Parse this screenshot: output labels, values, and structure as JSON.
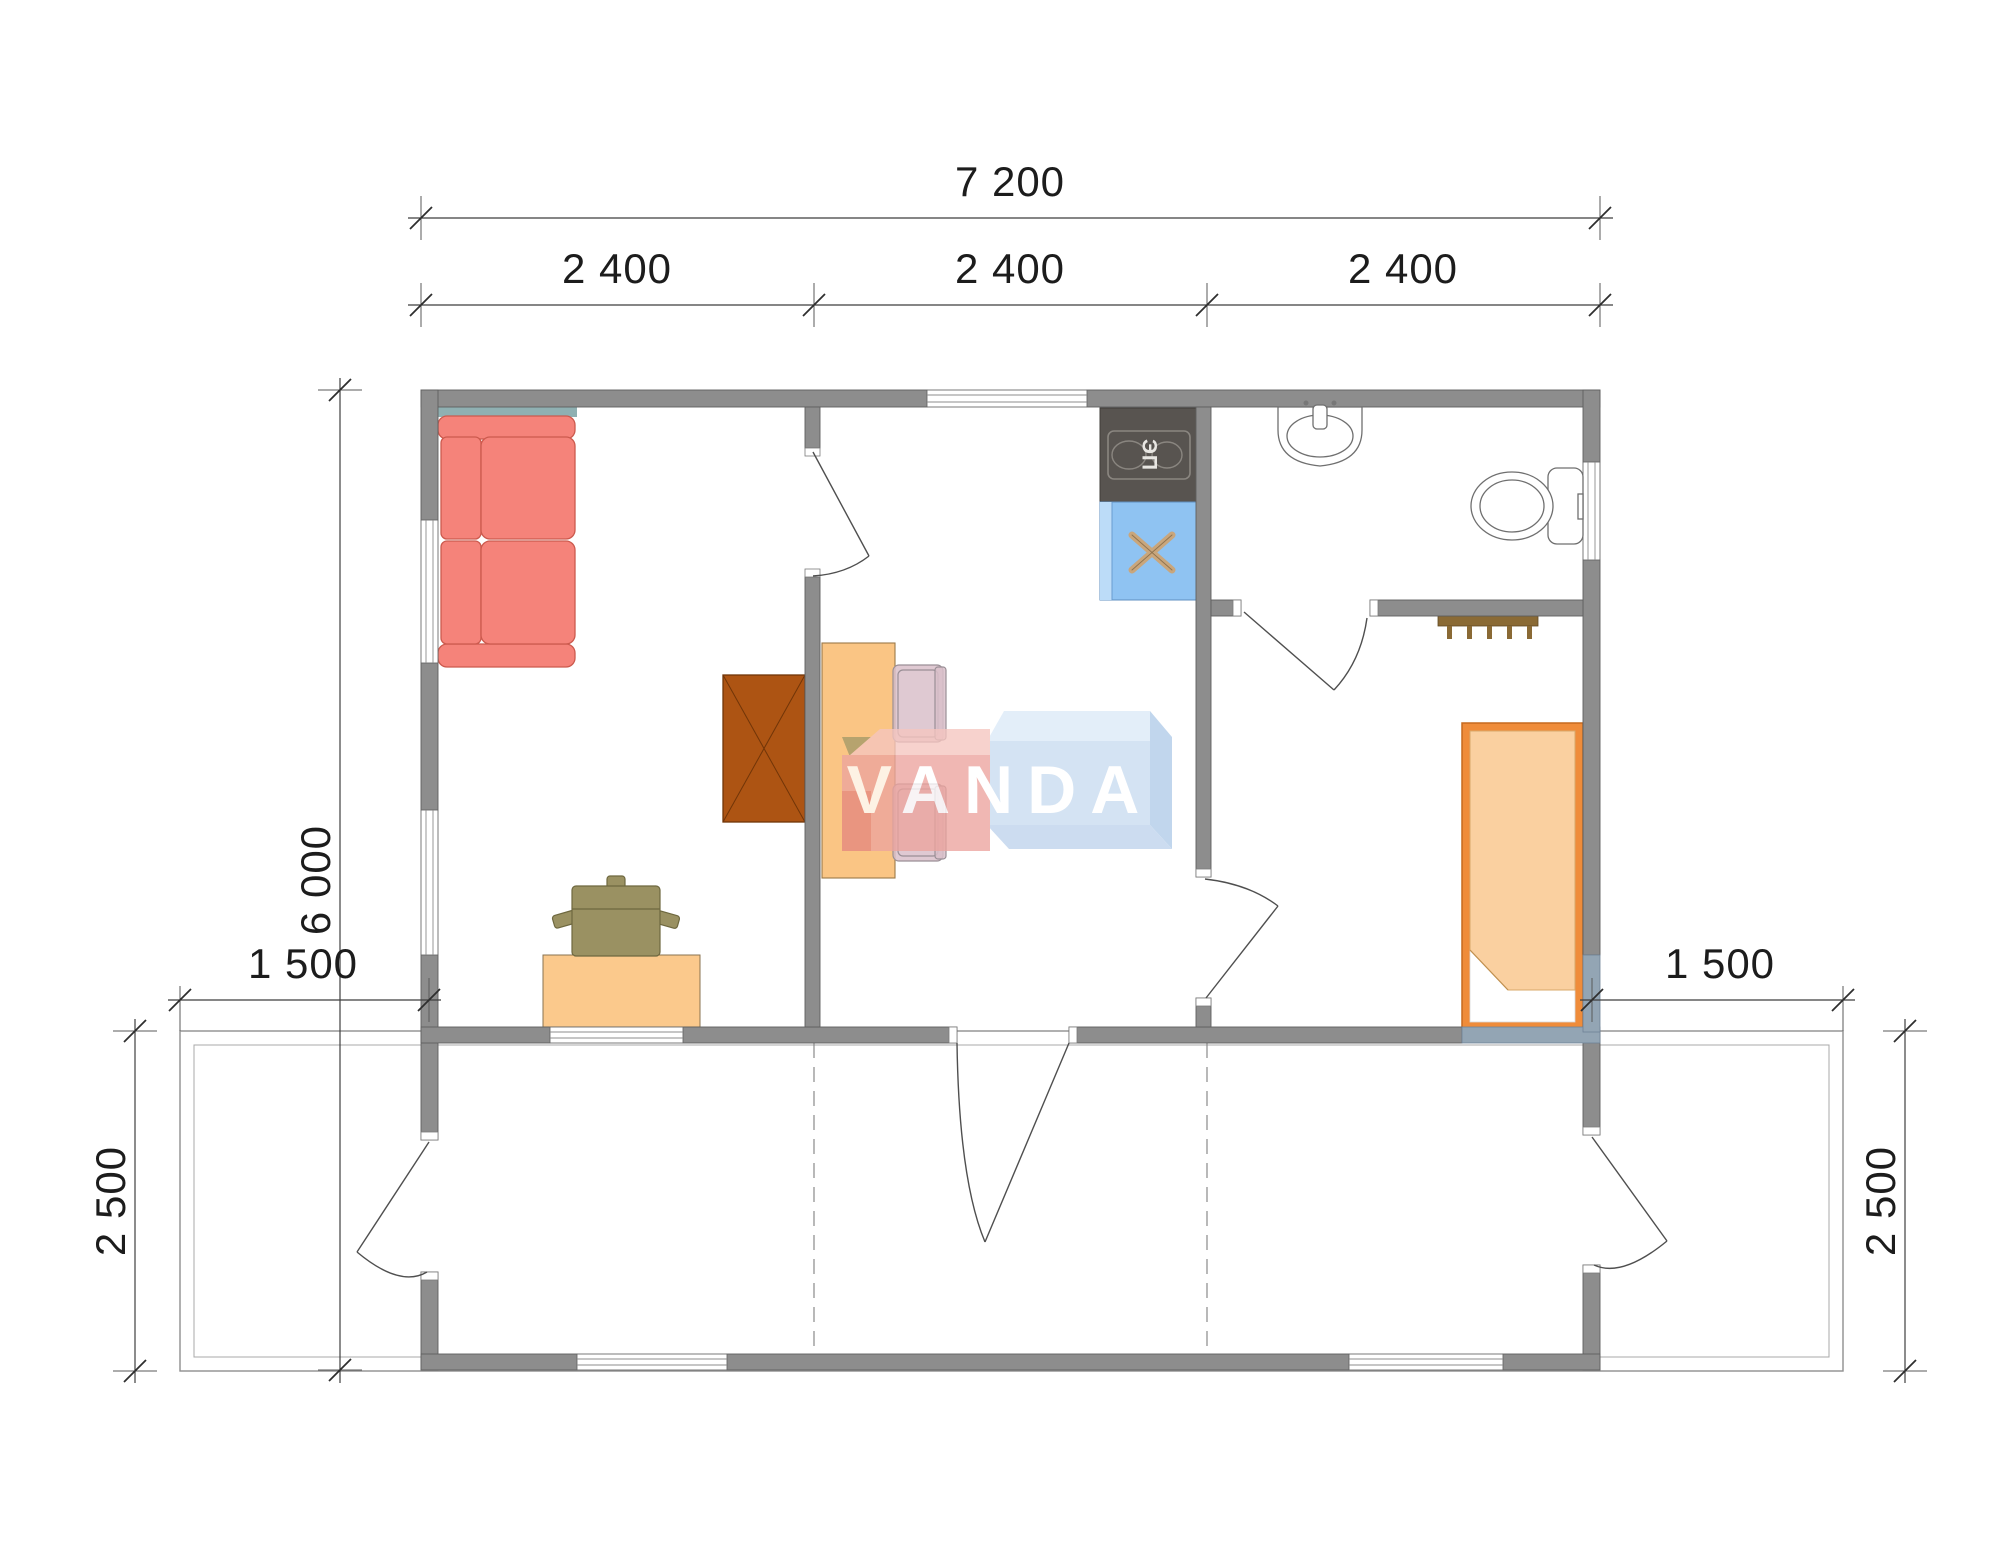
{
  "document": {
    "kind": "modular-house-floor-plan",
    "watermark": "VANDA"
  },
  "dimensions": {
    "total_width": "7 200",
    "module_widths": [
      "2 400",
      "2 400",
      "2 400"
    ],
    "total_depth": "6 000",
    "porch_width_left": "1 500",
    "porch_width_right": "1 500",
    "veranda_depth_left": "2 500",
    "veranda_depth_right": "2 500"
  },
  "labels": {
    "stove": "ЭП"
  },
  "colors": {
    "wall": "#8d8d8d",
    "sofa": "#f5837a",
    "sofa_shelf": "#8fb0b2",
    "wardrobe": "#ad5413",
    "dining_table": "#fac584",
    "desk": "#fbc98c",
    "office_chair": "#9a9162",
    "chair": "#d9c0ca",
    "stove_counter": "#585450",
    "sink_counter": "#8fc3f2",
    "sink_cross": "#c9a67c",
    "bed_frame": "#ef8c3a",
    "bed_blanket": "#fad0a0",
    "bed_bench": "#93a5b4",
    "hooks": "#8a6a35",
    "watermark_pink": "#eca49e",
    "watermark_blue": "#c8dcf0",
    "dimension_text": "#1c1c1c"
  }
}
